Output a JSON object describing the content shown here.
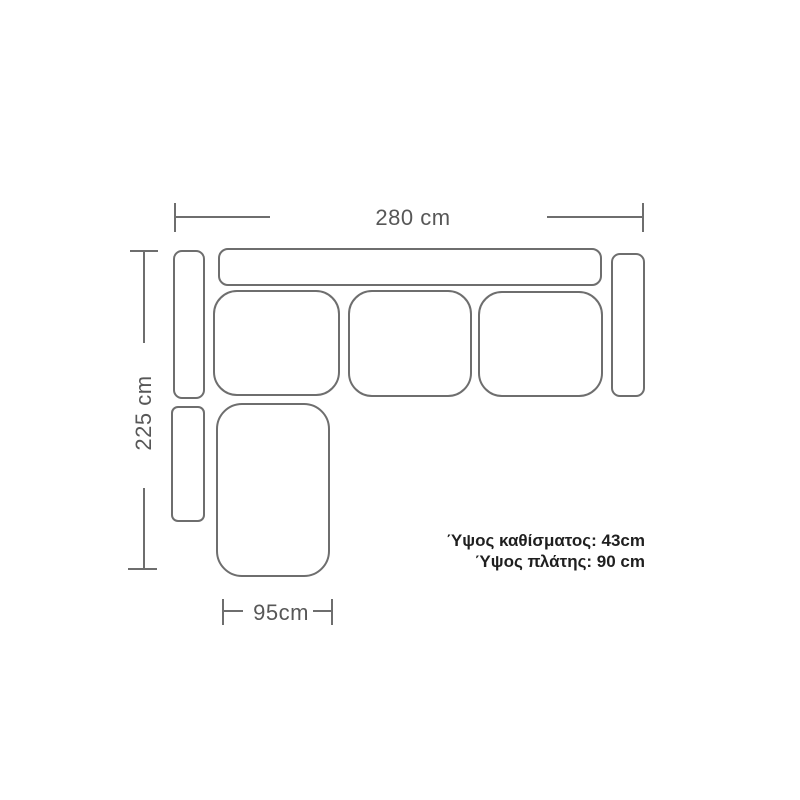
{
  "colors": {
    "background": "#ffffff",
    "line": "#6e6e6e",
    "dim-text": "#575757",
    "note-text": "#1f1f1f"
  },
  "dimensions": {
    "overall_width": {
      "label": "280 cm"
    },
    "overall_depth": {
      "label": "225 cm"
    },
    "chaise_width": {
      "label": "95cm"
    }
  },
  "notes": {
    "seat_height": "Ύψος καθίσματος: 43cm",
    "back_height": "Ύψος πλάτης: 90 cm"
  },
  "sofa": {
    "parts": [
      "back-cushion",
      "left-armrest-upper",
      "left-armrest-lower",
      "seat-cushion-1",
      "seat-cushion-2",
      "seat-cushion-3",
      "right-armrest",
      "chaise-seat"
    ]
  }
}
